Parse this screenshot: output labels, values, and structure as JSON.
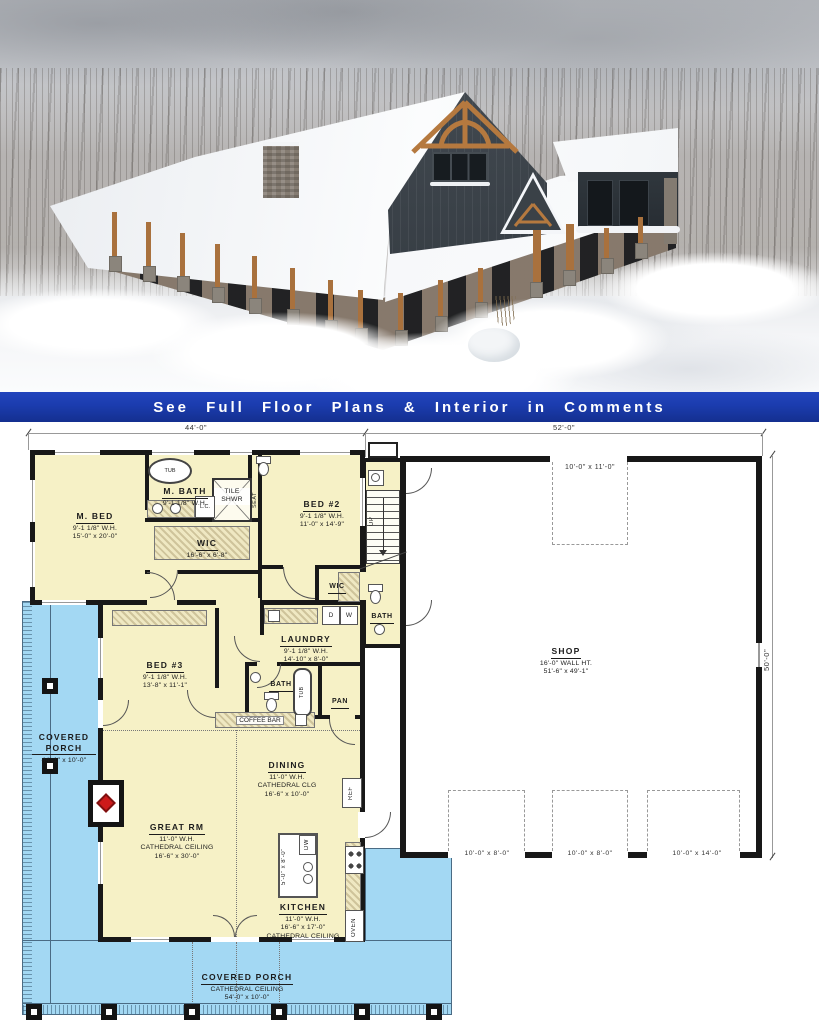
{
  "banner": {
    "text": "See Full Floor Plans & Interior in Comments"
  },
  "colors": {
    "banner-bg": "#1b3cae",
    "banner-fg": "#ffffff",
    "plan-yellow": "#f6f1c6",
    "porch-blue": "#a3d8f3",
    "wall-black": "#181818",
    "hatch-tan": "#efe8c2",
    "sky-gray": "#c9cbcf",
    "tree-gray": "#8f8a85",
    "snow-white": "#f4f6f8",
    "siding-dark": "#3a4147",
    "wood-brown": "#a9713d",
    "stone-gray": "#8b857c",
    "brick-brown": "#6e5247",
    "fireplace-red": "#cd1a1a"
  },
  "plan": {
    "dimensions": {
      "top_left": "44'-0\"",
      "top_right": "52'-0\"",
      "right_side": "50'-0\""
    },
    "rooms": {
      "m_bed": {
        "name": "M. BED",
        "wh": "9'-1 1/8\" W.H.",
        "size": "15'-0\" x 20'-0\""
      },
      "m_bath": {
        "name": "M. BATH",
        "wh": "9'-1 1/8\" W.H."
      },
      "wic": {
        "name": "WIC",
        "size": "16'-6\" x 6'-8\""
      },
      "bed2": {
        "name": "BED #2",
        "wh": "9'-1 1/8\" W.H.",
        "size": "11'-0\" x 14'-9\""
      },
      "wic2": {
        "name": "WIC"
      },
      "bed3": {
        "name": "BED #3",
        "wh": "9'-1 1/8\" W.H.",
        "size": "13'-8\" x 11'-1\""
      },
      "laundry": {
        "name": "LAUNDRY",
        "wh": "9'-1 1/8\" W.H.",
        "size": "14'-10\" x 8'-0\""
      },
      "bath_hall": {
        "name": "BATH"
      },
      "bath_shop": {
        "name": "BATH"
      },
      "pantry": {
        "name": "PAN"
      },
      "coffee_bar": {
        "name": "COFFEE BAR"
      },
      "dining": {
        "name": "DINING",
        "wh": "11'-0\" W.H.",
        "ceiling": "CATHEDRAL CLG",
        "size": "16'-6\" x 10'-0\""
      },
      "great_room": {
        "name": "GREAT RM",
        "wh": "11'-0\" W.H.",
        "ceiling": "CATHEDRAL CEILING",
        "size": "16'-6\" x 30'-0\""
      },
      "kitchen": {
        "name": "KITCHEN",
        "wh": "11'-0\" W.H.",
        "size": "16'-6\" x 17'-0\"",
        "ceiling": "CATHEDRAL CEILING"
      },
      "porch_left": {
        "name": "COVERED PORCH",
        "size": "44'-1\" x 10'-0\""
      },
      "porch_bottom": {
        "name": "COVERED PORCH",
        "ceiling": "CATHEDRAL CEILING",
        "size": "54'-0\" x 10'-0\""
      },
      "shop": {
        "name": "SHOP",
        "wh": "16'-0\" WALL HT.",
        "size": "51'-6\" x 49'-1\""
      }
    },
    "fixtures": {
      "tub": "TUB",
      "tile_line1": "TILE",
      "tile_line2": "SHWR",
      "seat": "SEAT",
      "linen": "L.C.",
      "stairs_up": "UP",
      "dryer": "D",
      "washer": "W",
      "dishwasher": "DW",
      "refrigerator": "REF",
      "oven": "OVEN",
      "island_size": "5'-0\" x 8'-0\""
    },
    "garage_doors": {
      "top": "10'-0\" x 11'-0\"",
      "bottom_left": "10'-0\" x 8'-0\"",
      "bottom_middle": "10'-0\" x 8'-0\"",
      "bottom_right": "10'-0\" x 14'-0\""
    }
  }
}
